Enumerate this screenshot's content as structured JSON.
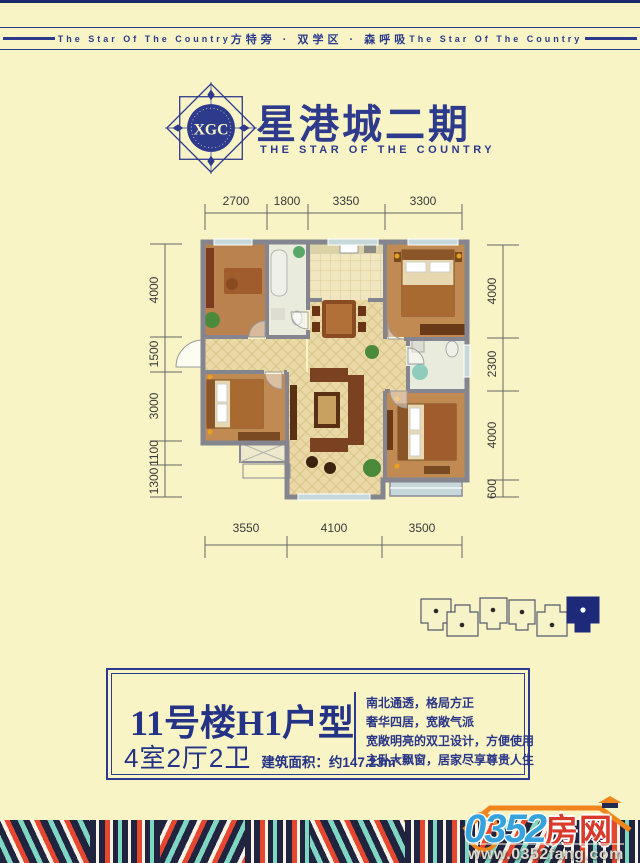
{
  "banner": {
    "left": "The Star Of The Country",
    "center": "方特旁 · 双学区 · 森呼吸",
    "right": "The Star Of The Country"
  },
  "brand": {
    "monogram": "XGC",
    "title": "星港城二期",
    "subtitle": "THE STAR OF THE COUNTRY"
  },
  "floorplan": {
    "dims_top": [
      "2700",
      "1800",
      "3350",
      "3300"
    ],
    "dims_left": [
      "4000",
      "1500",
      "3000",
      "1100",
      "1300"
    ],
    "dims_right": [
      "4000",
      "2300",
      "4000",
      "600"
    ],
    "dims_bottom": [
      "3550",
      "4100",
      "3500"
    ]
  },
  "info": {
    "title": "11号楼H1户型",
    "layout": "4室2厅2卫",
    "area": "建筑面积：约147.23m²",
    "features": [
      "南北通透，格局方正",
      "奢华四居，宽敞气派",
      "宽敞明亮的双卫设计，方便使用",
      "主卧大飘窗，居家尽享尊贵人生"
    ]
  },
  "watermark": {
    "number": "0352",
    "word": "房网",
    "url": "www.0352fang.com"
  },
  "colors": {
    "cream": "#f8f4c6",
    "navy": "#2b3a8c",
    "stripe_navy": "#20243e",
    "stripe_red": "#e8472f",
    "stripe_teal": "#7fd6c2",
    "logo_blue": "#36a3dc",
    "logo_red": "#d93a2b",
    "logo_orange": "#f0851c"
  }
}
